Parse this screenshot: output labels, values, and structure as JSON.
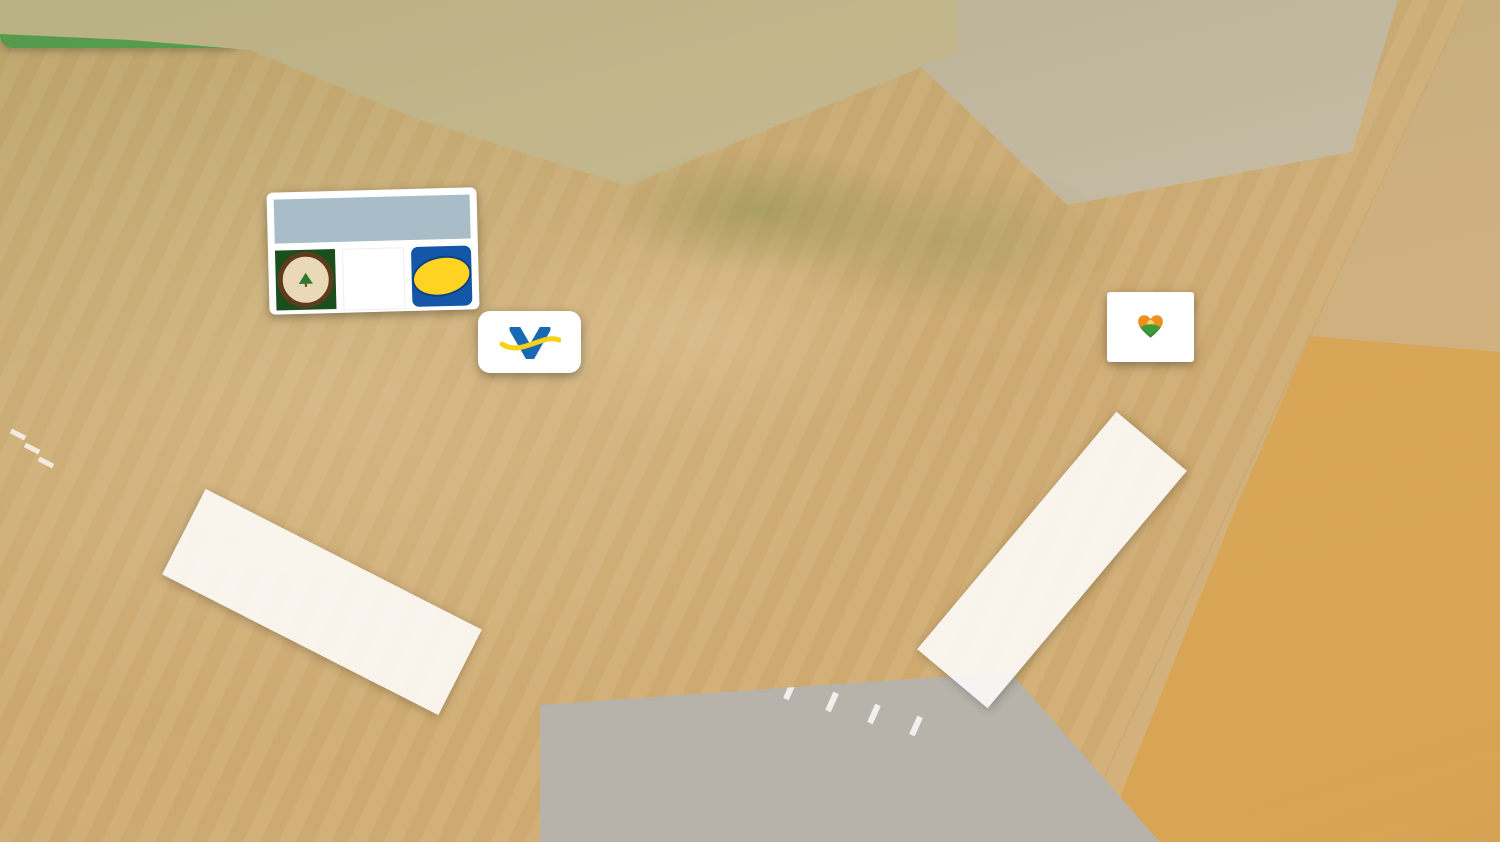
{
  "badge": {
    "label": "Subject Property",
    "bg_color": "#2d9c43",
    "text_color": "#ffffff"
  },
  "boundary": {
    "color": "#ee1b1b",
    "points": [
      [
        628,
        183
      ],
      [
        923,
        68
      ],
      [
        1347,
        152
      ],
      [
        1248,
        235
      ],
      [
        1067,
        207
      ],
      [
        623,
        553
      ]
    ]
  },
  "road_labels": {
    "ward": {
      "label": "Ward Road"
    },
    "highway": {
      "label": "Highway 152"
    }
  },
  "tenant_sign": {
    "header": "Dads Cookies",
    "rare_earth": {
      "line1": "Rare Earth",
      "line2": "COFFEE"
    },
    "w": {
      "letter": "W"
    },
    "day_night": {
      "line1": "DAY & NIGHT",
      "line2": "MARKETS"
    }
  },
  "valero": {
    "label": "Valero",
    "mark": "®"
  },
  "camarena": {
    "line1": "CAMARENA",
    "line2": "HEALTH"
  },
  "colors": {
    "boundary_red": "#ee1b1b",
    "badge_green": "#2d9c43",
    "valero_blue": "#1868b4",
    "valero_yellow": "#f7d117",
    "day_night_blue": "#1457a8",
    "day_night_yellow": "#ffd321",
    "rare_earth_green": "#194f1d",
    "w_red": "#d9292b",
    "camarena_text": "#454d55"
  }
}
